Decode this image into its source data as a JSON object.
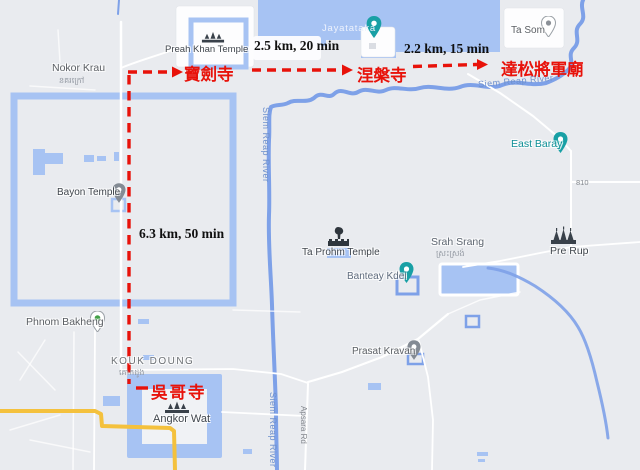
{
  "annotations": {
    "color": "#e8120a",
    "seg1_label": "2.5 km, 20 min",
    "seg2_label": "2.2 km, 15 min",
    "seg3_label": "6.3 km, 50 min",
    "stop_preah_khan": "寶劍寺",
    "stop_neak_pean": "涅槃寺",
    "stop_ta_som": "達松將軍廟",
    "stop_angkor_wat": "吳哥寺"
  },
  "places": {
    "nokor_krau": "Nokor Krau",
    "nokor_krau_khmer": "នគរក្រៅ",
    "preah_khan": "Preah Khan Temple",
    "jayatataka": "Jayatataka",
    "ta_som": "Ta Som",
    "east_baray": "East Baray",
    "pre_rup": "Pre Rup",
    "srah_srang": "Srah Srang",
    "srah_srang_khmer": "ស្រះស្រង់",
    "ta_prohm": "Ta Prohm Temple",
    "banteay_kdei": "Banteay Kdei",
    "prasat_kravan": "Prasat Kravan",
    "phnom_bakheng": "Phnom Bakheng",
    "kouk_doung": "KOUK DOUNG",
    "kouk_doung_khmer": "គោកដូង",
    "bayon": "Bayon Temple",
    "angkor_wat": "Angkor Wat"
  },
  "roads": {
    "route_810": "810",
    "apsara_rd": "Apsara Rd"
  },
  "water": {
    "siem_reap_river": "Siem Reap River"
  },
  "map_colors": {
    "background": "#e9ebef",
    "water": "#a7c3f3",
    "road_yellow": "#f4c13d"
  }
}
